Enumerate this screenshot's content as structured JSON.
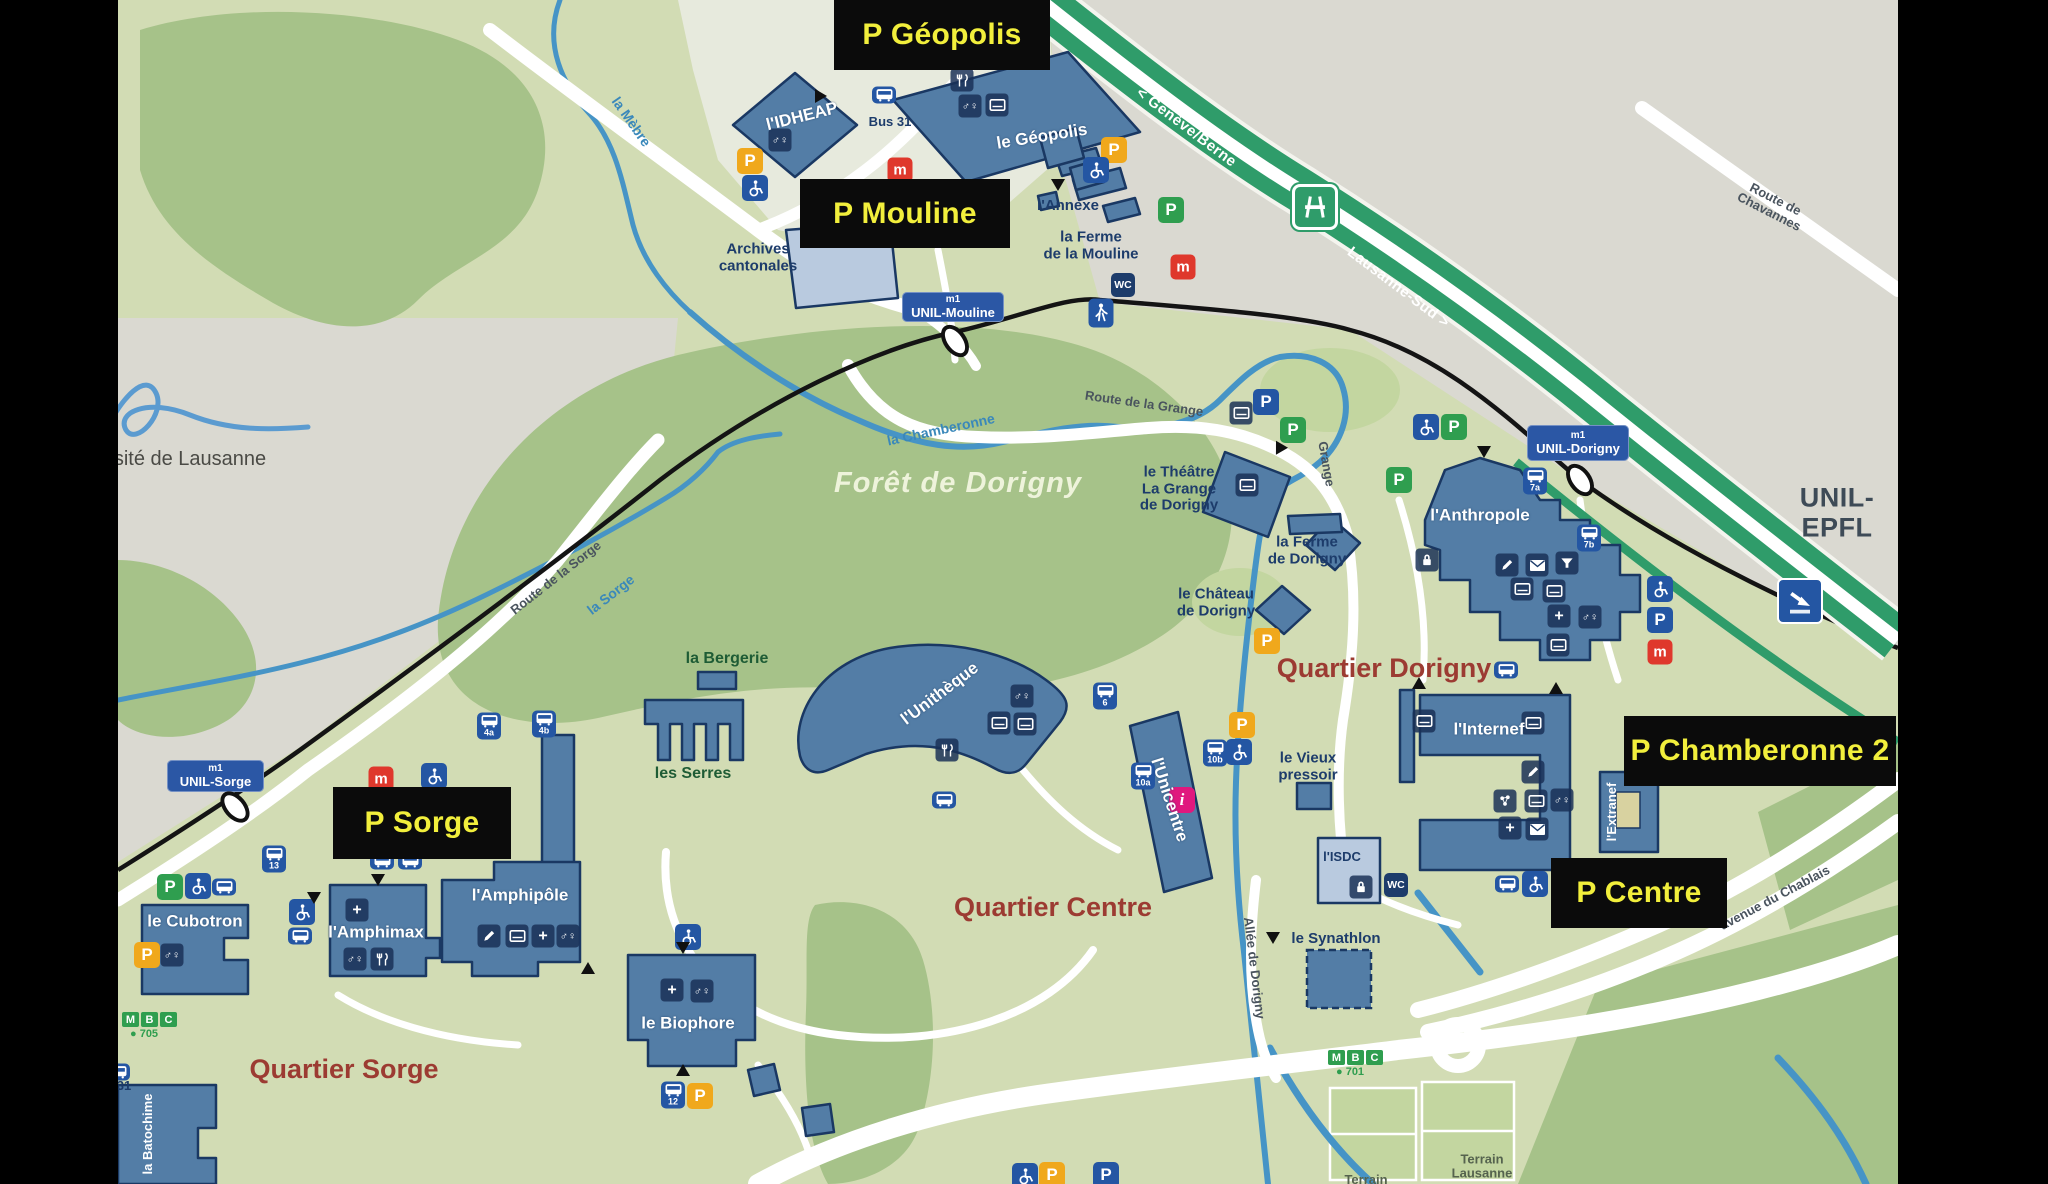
{
  "map": {
    "title_region": "UNIL campus map (Université de Lausanne) with parking overlay",
    "colors": {
      "background": "#d2dcb4",
      "urban_gray": "#dad9d1",
      "forest": "#a6c289",
      "building": "#537da6",
      "building_light": "#b9cadf",
      "building_border": "#1a3863",
      "motorway_green": "#2f9c6a",
      "river_blue": "#4694c6",
      "rail_black": "#141414",
      "parking_box_bg": "#0b0b0b",
      "parking_box_text": "#f2ef3c",
      "station_blue": "#2b57a5",
      "quartier_red": "#9c3b32",
      "p_yellow": "#f0a81c",
      "p_green": "#2f9e4f",
      "p_blue": "#2456a3",
      "metro_red": "#df382c",
      "info_pink": "#e0187e",
      "mbc_green": "#2f9e4f"
    },
    "icon_glyphs": {
      "p": "P",
      "m": "m",
      "wc": "WC",
      "gender": "♂♀",
      "plus": "+",
      "info": "i"
    },
    "parking_boxes": [
      {
        "n": "geopolis",
        "t": "P Géopolis",
        "x": 716,
        "y": 0,
        "w": 216,
        "h": 70
      },
      {
        "n": "mouline",
        "t": "P Mouline",
        "x": 682,
        "y": 179,
        "w": 210,
        "h": 69
      },
      {
        "n": "sorge",
        "t": "P Sorge",
        "x": 215,
        "y": 787,
        "w": 178,
        "h": 72
      },
      {
        "n": "chamberonne-2",
        "t": "P Chamberonne 2",
        "x": 1506,
        "y": 716,
        "w": 272,
        "h": 70
      },
      {
        "n": "centre",
        "t": "P Centre",
        "x": 1433,
        "y": 858,
        "w": 176,
        "h": 70
      }
    ],
    "stations": [
      {
        "n": "unil-mouline",
        "l1": "m1",
        "l2": "UNIL-Mouline",
        "x": 784,
        "y": 292,
        "w": 102,
        "h": 30,
        "ox": 837,
        "oy": 341,
        "or": -35
      },
      {
        "n": "unil-dorigny",
        "l1": "m1",
        "l2": "UNIL-Dorigny",
        "x": 1409,
        "y": 425,
        "w": 102,
        "h": 36,
        "ox": 1462,
        "oy": 480,
        "or": -35
      },
      {
        "n": "unil-sorge",
        "l1": "m1",
        "l2": "UNIL-Sorge",
        "x": 49,
        "y": 760,
        "w": 97,
        "h": 32,
        "ox": 117,
        "oy": 807,
        "or": -40
      }
    ],
    "labels": [
      {
        "c": "unil",
        "t": "UNIL-EPFL",
        "x": 1719,
        "y": 513
      },
      {
        "c": "logo",
        "t": "sité de Lausanne",
        "x": 72,
        "y": 459
      },
      {
        "c": "forest",
        "t": "Forêt de Dorigny",
        "x": 840,
        "y": 484
      },
      {
        "c": "quartier",
        "t": "Quartier Dorigny",
        "x": 1266,
        "y": 669
      },
      {
        "c": "quartier",
        "t": "Quartier Centre",
        "x": 935,
        "y": 908
      },
      {
        "c": "quartier",
        "t": "Quartier Sorge",
        "x": 226,
        "y": 1070
      },
      {
        "c": "navy",
        "t": "Archives\ncantonales",
        "x": 640,
        "y": 258
      },
      {
        "c": "navy",
        "t": "l'Annexe",
        "x": 950,
        "y": 206
      },
      {
        "c": "navy",
        "t": "la Ferme\nde la Mouline",
        "x": 973,
        "y": 246
      },
      {
        "c": "navy",
        "t": "le Théâtre\nLa Grange\nde Dorigny",
        "x": 1061,
        "y": 489
      },
      {
        "c": "navy",
        "t": "la Ferme\nde Dorigny",
        "x": 1189,
        "y": 551
      },
      {
        "c": "navy",
        "t": "le Château\nde Dorigny",
        "x": 1098,
        "y": 603
      },
      {
        "c": "navy",
        "t": "le Vieux\npressoir",
        "x": 1190,
        "y": 767
      },
      {
        "c": "navy",
        "t": "le Synathlon",
        "x": 1218,
        "y": 939
      },
      {
        "c": "terrain",
        "t": "Terrain\nLausanne",
        "x": 1364,
        "y": 1167
      },
      {
        "c": "terrain",
        "t": "Terrain",
        "x": 1248,
        "y": 1180
      },
      {
        "c": "busline",
        "t": "Bus 31",
        "x": 772,
        "y": 122
      },
      {
        "c": "busline",
        "t": "31",
        "x": 6,
        "y": 1086
      },
      {
        "c": "green",
        "t": "la Bergerie",
        "x": 609,
        "y": 659
      },
      {
        "c": "green",
        "t": "les Serres",
        "x": 575,
        "y": 774
      },
      {
        "c": "white",
        "t": "le Géopolis",
        "x": 924,
        "y": 137,
        "r": -9
      },
      {
        "c": "white",
        "t": "l'IDHEAP",
        "x": 684,
        "y": 117,
        "r": -14
      },
      {
        "c": "white",
        "t": "l'Anthropole",
        "x": 1362,
        "y": 516
      },
      {
        "c": "white",
        "t": "l'Internef",
        "x": 1371,
        "y": 730
      },
      {
        "c": "white",
        "t": "l'Unithèque",
        "x": 822,
        "y": 694,
        "r": -37
      },
      {
        "c": "white",
        "t": "l'Unicentre",
        "x": 1051,
        "y": 800,
        "r": 72
      },
      {
        "c": "whiteS",
        "t": "l'Extranef",
        "x": 1494,
        "y": 812,
        "r": -90
      },
      {
        "c": "navyS",
        "t": "l'ISDC",
        "x": 1224,
        "y": 857
      },
      {
        "c": "white",
        "t": "l'Amphipôle",
        "x": 402,
        "y": 896
      },
      {
        "c": "white",
        "t": "l'Amphimax",
        "x": 258,
        "y": 933
      },
      {
        "c": "white",
        "t": "le Cubotron",
        "x": 77,
        "y": 922
      },
      {
        "c": "white",
        "t": "le Biophore",
        "x": 570,
        "y": 1024
      },
      {
        "c": "whiteS",
        "t": "la Batochime",
        "x": 30,
        "y": 1134,
        "r": -90
      },
      {
        "c": "roadw",
        "t": "< Genève/Berne",
        "x": 1068,
        "y": 128,
        "r": 37
      },
      {
        "c": "roadw",
        "t": "Lausanne-Sud >",
        "x": 1280,
        "y": 288,
        "r": 37
      },
      {
        "c": "road",
        "t": "Route de Chavannes",
        "x": 1654,
        "y": 206,
        "r": 27
      },
      {
        "c": "road",
        "t": "Route de la Grange",
        "x": 1026,
        "y": 404,
        "r": 8
      },
      {
        "c": "road",
        "t": "Route de la Sorge",
        "x": 438,
        "y": 578,
        "r": -38
      },
      {
        "c": "road",
        "t": "avenue du Chablais",
        "x": 1657,
        "y": 898,
        "r": -28
      },
      {
        "c": "road",
        "t": "Allée de Dorigny",
        "x": 1136,
        "y": 968,
        "r": 83
      },
      {
        "c": "road",
        "t": "Grange",
        "x": 1208,
        "y": 464,
        "r": 80
      },
      {
        "c": "river",
        "t": "la Mèbre",
        "x": 513,
        "y": 122,
        "r": 55
      },
      {
        "c": "river",
        "t": "la Chamberonne",
        "x": 823,
        "y": 430,
        "r": -12
      },
      {
        "c": "river",
        "t": "la Sorge",
        "x": 493,
        "y": 595,
        "r": -38
      }
    ],
    "mbc": [
      {
        "t": "MBC",
        "sub": "705",
        "x": 4,
        "y": 1026
      },
      {
        "t": "MBC",
        "sub": "701",
        "x": 1210,
        "y": 1064
      }
    ],
    "icons": [
      {
        "k": "py",
        "x": 632,
        "y": 161
      },
      {
        "k": "py",
        "x": 996,
        "y": 150
      },
      {
        "k": "py",
        "x": 1124,
        "y": 725
      },
      {
        "k": "py",
        "x": 1149,
        "y": 641
      },
      {
        "k": "py",
        "x": 29,
        "y": 955
      },
      {
        "k": "py",
        "x": 582,
        "y": 1096
      },
      {
        "k": "py",
        "x": 934,
        "y": 1175
      },
      {
        "k": "pg",
        "x": 1053,
        "y": 210
      },
      {
        "k": "pg",
        "x": 1175,
        "y": 430
      },
      {
        "k": "pg",
        "x": 1336,
        "y": 427
      },
      {
        "k": "pg",
        "x": 1281,
        "y": 480
      },
      {
        "k": "pg",
        "x": 52,
        "y": 887
      },
      {
        "k": "pb",
        "x": 1148,
        "y": 402
      },
      {
        "k": "pb",
        "x": 1542,
        "y": 620
      },
      {
        "k": "pb",
        "x": 988,
        "y": 1175
      },
      {
        "k": "m",
        "x": 782,
        "y": 170
      },
      {
        "k": "m",
        "x": 1065,
        "y": 267
      },
      {
        "k": "m",
        "x": 1542,
        "y": 652
      },
      {
        "k": "m",
        "x": 263,
        "y": 779
      },
      {
        "k": "acc",
        "x": 637,
        "y": 188
      },
      {
        "k": "acc",
        "x": 978,
        "y": 170
      },
      {
        "k": "acc",
        "x": 1308,
        "y": 427
      },
      {
        "k": "acc",
        "x": 1542,
        "y": 589
      },
      {
        "k": "acc",
        "x": 1121,
        "y": 752
      },
      {
        "k": "acc",
        "x": 1417,
        "y": 884
      },
      {
        "k": "acc",
        "x": 316,
        "y": 776
      },
      {
        "k": "acc",
        "x": 80,
        "y": 886
      },
      {
        "k": "acc",
        "x": 184,
        "y": 912
      },
      {
        "k": "acc",
        "x": 570,
        "y": 937
      },
      {
        "k": "acc",
        "x": 907,
        "y": 1176
      },
      {
        "k": "wc",
        "x": 1005,
        "y": 285
      },
      {
        "k": "wc",
        "x": 1278,
        "y": 885
      },
      {
        "k": "walk",
        "x": 983,
        "y": 313
      },
      {
        "k": "food",
        "x": 844,
        "y": 80
      },
      {
        "k": "food",
        "x": 829,
        "y": 750
      },
      {
        "k": "food",
        "x": 264,
        "y": 959
      },
      {
        "k": "gender",
        "x": 852,
        "y": 106
      },
      {
        "k": "gender",
        "x": 662,
        "y": 140
      },
      {
        "k": "gender",
        "x": 904,
        "y": 696
      },
      {
        "k": "gender",
        "x": 1444,
        "y": 800
      },
      {
        "k": "gender",
        "x": 1472,
        "y": 617
      },
      {
        "k": "gender",
        "x": 54,
        "y": 955
      },
      {
        "k": "gender",
        "x": 237,
        "y": 959
      },
      {
        "k": "gender",
        "x": 450,
        "y": 936
      },
      {
        "k": "gender",
        "x": 584,
        "y": 991
      },
      {
        "k": "card",
        "x": 879,
        "y": 105
      },
      {
        "k": "card",
        "x": 1123,
        "y": 413
      },
      {
        "k": "card",
        "x": 1129,
        "y": 485
      },
      {
        "k": "card",
        "x": 1404,
        "y": 589
      },
      {
        "k": "card",
        "x": 1436,
        "y": 591
      },
      {
        "k": "card",
        "x": 1440,
        "y": 645
      },
      {
        "k": "card",
        "x": 1306,
        "y": 721
      },
      {
        "k": "card",
        "x": 1415,
        "y": 723
      },
      {
        "k": "card",
        "x": 881,
        "y": 723
      },
      {
        "k": "card",
        "x": 907,
        "y": 724
      },
      {
        "k": "card",
        "x": 1418,
        "y": 801
      },
      {
        "k": "card",
        "x": 399,
        "y": 936
      },
      {
        "k": "pencil",
        "x": 1389,
        "y": 565
      },
      {
        "k": "pencil",
        "x": 1415,
        "y": 772
      },
      {
        "k": "pencil",
        "x": 371,
        "y": 936
      },
      {
        "k": "env",
        "x": 1419,
        "y": 565
      },
      {
        "k": "env",
        "x": 1419,
        "y": 829
      },
      {
        "k": "plus",
        "x": 1441,
        "y": 616
      },
      {
        "k": "plus",
        "x": 1392,
        "y": 828
      },
      {
        "k": "plus",
        "x": 239,
        "y": 910
      },
      {
        "k": "plus",
        "x": 425,
        "y": 936
      },
      {
        "k": "plus",
        "x": 554,
        "y": 990
      },
      {
        "k": "funnel",
        "x": 1449,
        "y": 563
      },
      {
        "k": "lock",
        "x": 1309,
        "y": 560
      },
      {
        "k": "lock",
        "x": 1243,
        "y": 887
      },
      {
        "k": "mol",
        "x": 1387,
        "y": 801
      },
      {
        "k": "info",
        "x": 1064,
        "y": 800
      },
      {
        "k": "moto",
        "x": 1197,
        "y": 207
      },
      {
        "k": "arr",
        "x": 1682,
        "y": 601
      },
      {
        "k": "bus",
        "x": 766,
        "y": 95
      },
      {
        "k": "bus",
        "x": 1388,
        "y": 670
      },
      {
        "k": "bus",
        "x": 826,
        "y": 800
      },
      {
        "k": "bus",
        "x": 1389,
        "y": 884
      },
      {
        "k": "bus",
        "x": 264,
        "y": 861
      },
      {
        "k": "bus",
        "x": 292,
        "y": 861
      },
      {
        "k": "bus",
        "x": 106,
        "y": 887
      },
      {
        "k": "bus",
        "x": 182,
        "y": 936
      },
      {
        "k": "bus",
        "x": 0,
        "y": 1072
      },
      {
        "k": "bus",
        "x": 1417,
        "y": 481,
        "l": "7a"
      },
      {
        "k": "bus",
        "x": 1471,
        "y": 538,
        "l": "7b"
      },
      {
        "k": "bus",
        "x": 987,
        "y": 696,
        "l": "6"
      },
      {
        "k": "bus",
        "x": 1025,
        "y": 776,
        "l": "10a"
      },
      {
        "k": "bus",
        "x": 1097,
        "y": 753,
        "l": "10b"
      },
      {
        "k": "bus",
        "x": 371,
        "y": 726,
        "l": "4a"
      },
      {
        "k": "bus",
        "x": 426,
        "y": 724,
        "l": "4b"
      },
      {
        "k": "bus",
        "x": 156,
        "y": 859,
        "l": "13"
      },
      {
        "k": "bus",
        "x": 555,
        "y": 1095,
        "l": "12"
      }
    ],
    "tris": [
      {
        "x": 703,
        "y": 96,
        "r": 90
      },
      {
        "x": 940,
        "y": 185,
        "r": 180
      },
      {
        "x": 1161,
        "y": 446,
        "r": -30
      },
      {
        "x": 1366,
        "y": 452,
        "r": 180
      },
      {
        "x": 1301,
        "y": 683,
        "r": 0
      },
      {
        "x": 1438,
        "y": 688,
        "r": 0
      },
      {
        "x": 196,
        "y": 898,
        "r": 180
      },
      {
        "x": 565,
        "y": 948,
        "r": 180
      },
      {
        "x": 565,
        "y": 1070,
        "r": 0
      },
      {
        "x": 260,
        "y": 880,
        "r": 180
      },
      {
        "x": 470,
        "y": 968,
        "r": 0
      },
      {
        "x": 1155,
        "y": 938,
        "r": 180
      }
    ]
  }
}
